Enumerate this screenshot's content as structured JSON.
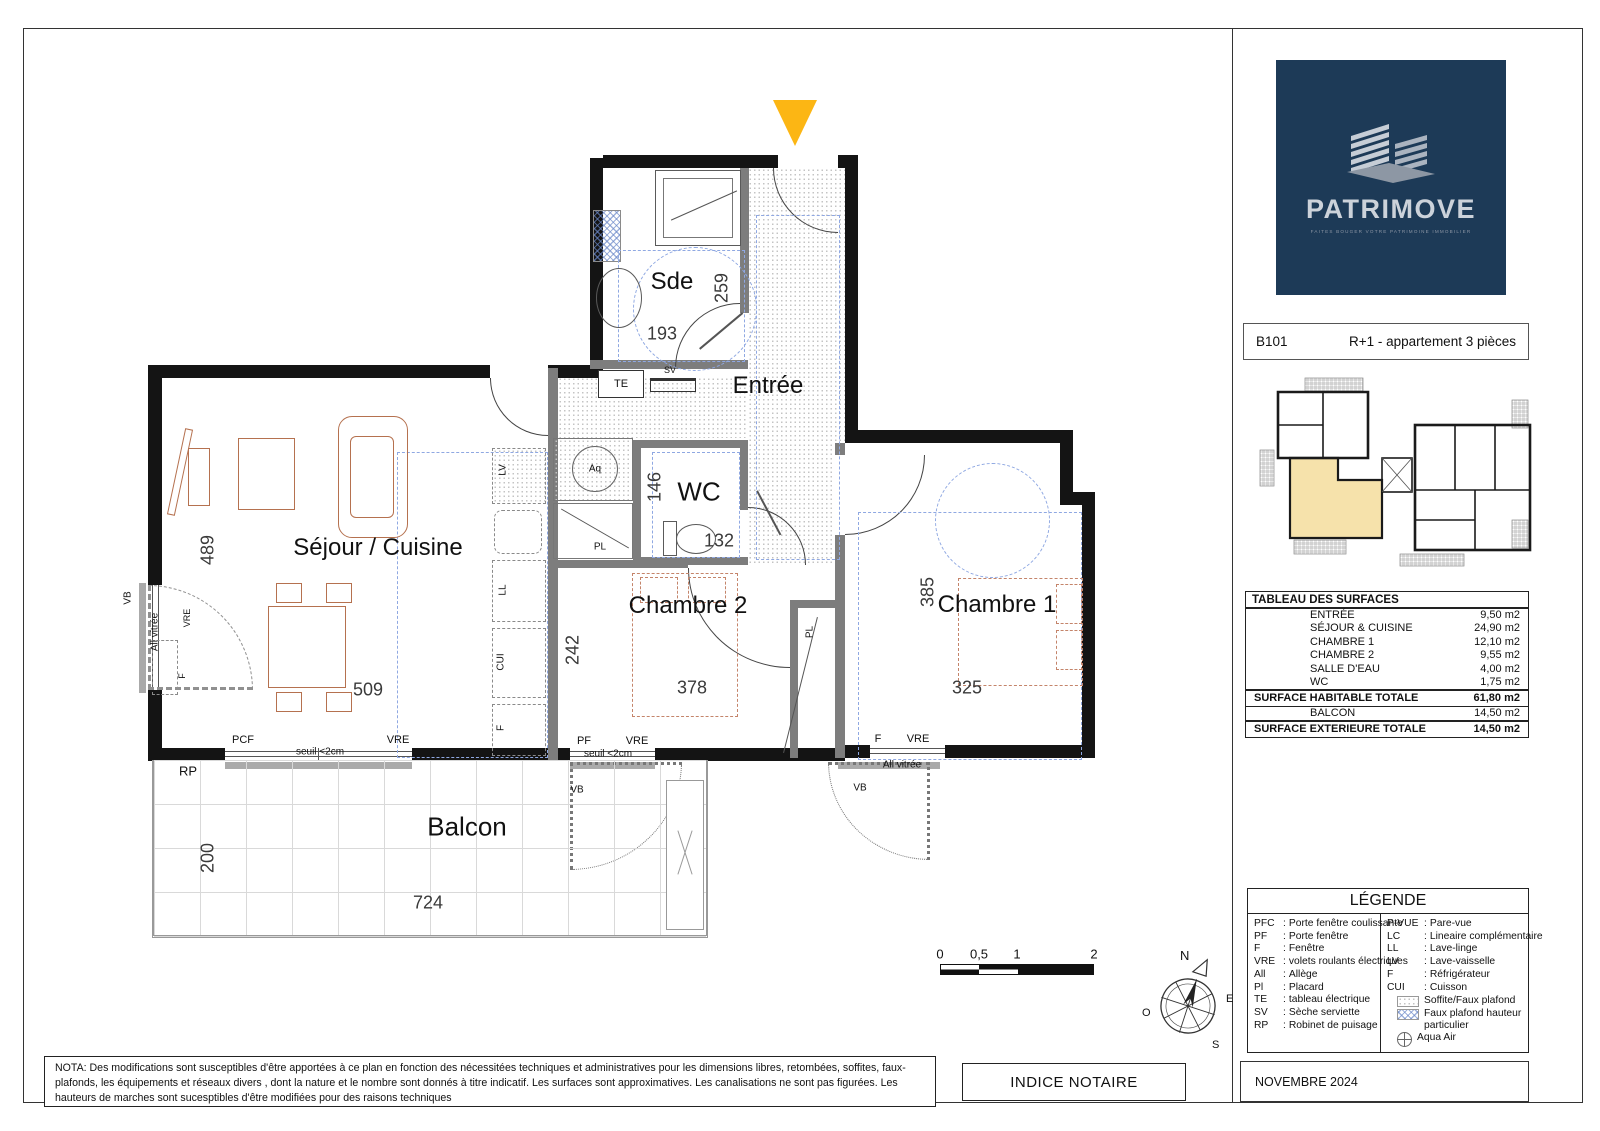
{
  "sheet": {
    "date": "NOVEMBRE 2024",
    "indice": "INDICE NOTAIRE",
    "nota": "NOTA: Des modifications sont susceptibles d'être apportées à ce plan en fonction des nécessitées techniques et administratives pour les dimensions libres, retombées, soffites, faux-plafonds, les équipements et réseaux divers , dont la nature et le nombre sont donnés à titre indicatif. Les surfaces sont approximatives. Les canalisations ne sont pas figurées. Les hauteurs de marches sont sucesptibles d'être modifiées pour des raisons techniques"
  },
  "logo": {
    "name": "PATRIMOVE",
    "tagline": "FAITES BOUGER VOTRE PATRIMOINE IMMOBILIER"
  },
  "header": {
    "lot": "B101",
    "title": "R+1 - appartement 3 pièces"
  },
  "surfaces": {
    "title": "TABLEAU DES SURFACES",
    "rows": [
      {
        "name": "ENTRÉE",
        "value": "9,50 m2"
      },
      {
        "name": "SÉJOUR & CUISINE",
        "value": "24,90 m2"
      },
      {
        "name": "CHAMBRE 1",
        "value": "12,10 m2"
      },
      {
        "name": "CHAMBRE 2",
        "value": "9,55 m2"
      },
      {
        "name": "SALLE D'EAU",
        "value": "4,00 m2"
      },
      {
        "name": "WC",
        "value": "1,75 m2"
      }
    ],
    "totals": [
      {
        "name": "SURFACE HABITABLE TOTALE",
        "value": "61,80 m2"
      },
      {
        "name": "BALCON",
        "value": "14,50 m2"
      },
      {
        "name": "SURFACE EXTERIEURE TOTALE",
        "value": "14,50 m2"
      }
    ]
  },
  "legend": {
    "title": "LÉGENDE",
    "left": [
      {
        "abbr": "PFC",
        "label": "Porte fenêtre coulissante"
      },
      {
        "abbr": "PF",
        "label": "Porte fenêtre"
      },
      {
        "abbr": "F",
        "label": "Fenêtre"
      },
      {
        "abbr": "VRE",
        "label": "volets roulants électriques"
      },
      {
        "abbr": "All",
        "label": "Allège"
      },
      {
        "abbr": "Pl",
        "label": "Placard"
      },
      {
        "abbr": "TE",
        "label": "tableau électrique"
      },
      {
        "abbr": "SV",
        "label": "Sèche serviette"
      },
      {
        "abbr": "RP",
        "label": "Robinet de puisage"
      }
    ],
    "right": [
      {
        "abbr": "P-VUE",
        "label": "Pare-vue"
      },
      {
        "abbr": "LC",
        "label": "Lineaire complémentaire"
      },
      {
        "abbr": "LL",
        "label": "Lave-linge"
      },
      {
        "abbr": "LV",
        "label": "Lave-vaisselle"
      },
      {
        "abbr": "F",
        "label": "Réfrigérateur"
      },
      {
        "abbr": "CUI",
        "label": "Cuisson"
      }
    ],
    "swatches": [
      {
        "label": "Soffite/Faux plafond"
      },
      {
        "label": "Faux plafond hauteur particulier"
      },
      {
        "label": "Aqua Air"
      }
    ]
  },
  "scalebar": {
    "t0": "0",
    "t1": "0,5",
    "t2": "1",
    "t3": "2"
  },
  "compass": {
    "n": "N",
    "e": "E",
    "s": "S",
    "o": "O"
  },
  "rooms": {
    "sejour": {
      "label": "Séjour / Cuisine",
      "h": "489",
      "w": "509"
    },
    "sde": {
      "label": "Sde",
      "h": "259",
      "w": "193"
    },
    "entree": {
      "label": "Entrée"
    },
    "wc": {
      "label": "WC",
      "h": "146",
      "w": "132"
    },
    "chambre2": {
      "label": "Chambre 2",
      "h": "242",
      "w": "378"
    },
    "chambre1": {
      "label": "Chambre 1",
      "h": "385",
      "w": "325"
    },
    "balcon": {
      "label": "Balcon",
      "h": "200",
      "w": "724"
    }
  },
  "tags": {
    "te": "TE",
    "sv": "SV",
    "aq": "Aq",
    "pl": "PL",
    "lv": "LV",
    "ll": "LL",
    "cui": "CUI",
    "f": "F",
    "vb": "VB",
    "allv": "All vitrée",
    "vre": "VRE",
    "pcf": "PCF",
    "pf": "PF",
    "seuil": "seuil <2cm",
    "rp": "RP"
  },
  "colors": {
    "accent_arrow": "#fcb614",
    "logo_bg": "#1d3a57",
    "unit_highlight": "#f6e2ab"
  }
}
